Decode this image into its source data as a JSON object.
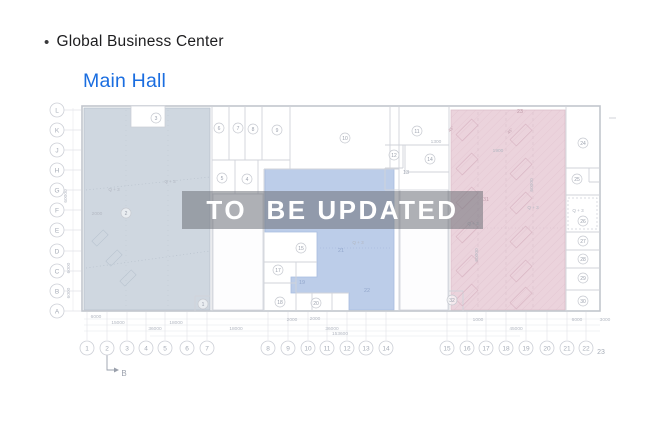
{
  "header": {
    "bullet": "•",
    "title": "Global Business Center",
    "subtitle": "Main Hall"
  },
  "watermark": {
    "text": "TO  BE UPDATED"
  },
  "plan": {
    "row_axis": [
      {
        "label": "L",
        "y": 110
      },
      {
        "label": "K",
        "y": 130
      },
      {
        "label": "J",
        "y": 150
      },
      {
        "label": "H",
        "y": 170
      },
      {
        "label": "G",
        "y": 190
      },
      {
        "label": "F",
        "y": 210
      },
      {
        "label": "E",
        "y": 230
      },
      {
        "label": "D",
        "y": 251
      },
      {
        "label": "C",
        "y": 271
      },
      {
        "label": "B",
        "y": 291
      },
      {
        "label": "A",
        "y": 311
      }
    ],
    "col_axis": [
      {
        "label": "1",
        "x": 87
      },
      {
        "label": "2",
        "x": 107
      },
      {
        "label": "3",
        "x": 127
      },
      {
        "label": "4",
        "x": 146
      },
      {
        "label": "5",
        "x": 165
      },
      {
        "label": "6",
        "x": 187
      },
      {
        "label": "7",
        "x": 207
      },
      {
        "label": "8",
        "x": 268
      },
      {
        "label": "9",
        "x": 288
      },
      {
        "label": "10",
        "x": 308
      },
      {
        "label": "11",
        "x": 327
      },
      {
        "label": "12",
        "x": 347
      },
      {
        "label": "13",
        "x": 366
      },
      {
        "label": "14",
        "x": 386
      },
      {
        "label": "15",
        "x": 447
      },
      {
        "label": "16",
        "x": 467
      },
      {
        "label": "17",
        "x": 486
      },
      {
        "label": "18",
        "x": 506
      },
      {
        "label": "19",
        "x": 526
      },
      {
        "label": "20",
        "x": 547
      },
      {
        "label": "21",
        "x": 567
      },
      {
        "label": "22",
        "x": 586
      }
    ],
    "col_axis_plain": {
      "label": "23",
      "x": 601,
      "y": 354
    },
    "section_marker": {
      "label": "B"
    },
    "rooms_circled": [
      {
        "n": "3",
        "x": 156,
        "y": 118
      },
      {
        "n": "6",
        "x": 219,
        "y": 128
      },
      {
        "n": "7",
        "x": 238,
        "y": 128
      },
      {
        "n": "8",
        "x": 253,
        "y": 129
      },
      {
        "n": "9",
        "x": 277,
        "y": 130
      },
      {
        "n": "10",
        "x": 345,
        "y": 138
      },
      {
        "n": "11",
        "x": 417,
        "y": 131
      },
      {
        "n": "12",
        "x": 394,
        "y": 155
      },
      {
        "n": "14",
        "x": 430,
        "y": 159
      },
      {
        "n": "5",
        "x": 222,
        "y": 178
      },
      {
        "n": "4",
        "x": 247,
        "y": 179
      },
      {
        "n": "2",
        "x": 126,
        "y": 213
      },
      {
        "n": "1",
        "x": 203,
        "y": 304
      },
      {
        "n": "15",
        "x": 301,
        "y": 248
      },
      {
        "n": "17",
        "x": 278,
        "y": 270
      },
      {
        "n": "18",
        "x": 280,
        "y": 302
      },
      {
        "n": "20",
        "x": 316,
        "y": 303
      },
      {
        "n": "24",
        "x": 583,
        "y": 143
      },
      {
        "n": "25",
        "x": 577,
        "y": 179
      },
      {
        "n": "26",
        "x": 583,
        "y": 221
      },
      {
        "n": "27",
        "x": 583,
        "y": 241
      },
      {
        "n": "28",
        "x": 583,
        "y": 259
      },
      {
        "n": "29",
        "x": 583,
        "y": 278
      },
      {
        "n": "30",
        "x": 583,
        "y": 301
      },
      {
        "n": "32",
        "x": 452,
        "y": 300
      }
    ],
    "rooms_plain": [
      {
        "n": "13",
        "x": 406,
        "y": 174,
        "c": "#a3a9b4"
      },
      {
        "n": "19",
        "x": 302,
        "y": 284,
        "c": "#93a7cc"
      },
      {
        "n": "21",
        "x": 341,
        "y": 252,
        "c": "#93a7cc"
      },
      {
        "n": "22",
        "x": 367,
        "y": 292,
        "c": "#93a7cc"
      },
      {
        "n": "31",
        "x": 486,
        "y": 201,
        "c": "#c3a0ae"
      },
      {
        "n": "23",
        "x": 520,
        "y": 113,
        "c": "#c09aa8"
      }
    ],
    "zone_labels": [
      {
        "t": "Q + 3",
        "x": 170,
        "y": 183
      },
      {
        "t": "Q + 3",
        "x": 114,
        "y": 191
      },
      {
        "t": "Q + 3",
        "x": 358,
        "y": 244
      },
      {
        "t": "Q + 3",
        "x": 473,
        "y": 225
      },
      {
        "t": "Q + 3",
        "x": 533,
        "y": 209
      },
      {
        "t": "Q + 3",
        "x": 578,
        "y": 212
      }
    ],
    "dims": [
      {
        "t": "6000",
        "x": 96,
        "y": 318
      },
      {
        "t": "15000",
        "x": 118,
        "y": 324
      },
      {
        "t": "18000",
        "x": 176,
        "y": 324
      },
      {
        "t": "36000",
        "x": 155,
        "y": 330
      },
      {
        "t": "18000",
        "x": 236,
        "y": 330
      },
      {
        "t": "2000",
        "x": 292,
        "y": 321
      },
      {
        "t": "36000",
        "x": 332,
        "y": 330
      },
      {
        "t": "153600",
        "x": 340,
        "y": 335
      },
      {
        "t": "2000",
        "x": 315,
        "y": 320
      },
      {
        "t": "1000",
        "x": 478,
        "y": 321
      },
      {
        "t": "45000",
        "x": 516,
        "y": 330
      },
      {
        "t": "6000",
        "x": 577,
        "y": 321
      },
      {
        "t": "3000",
        "x": 605,
        "y": 321
      },
      {
        "t": "1300",
        "x": 436,
        "y": 143
      },
      {
        "t": "1900",
        "x": 498,
        "y": 152
      },
      {
        "t": "2000",
        "x": 97,
        "y": 215
      },
      {
        "t": "60000",
        "x": 67,
        "y": 196,
        "rot": -90
      },
      {
        "t": "6000",
        "x": 70,
        "y": 268,
        "rot": -90
      },
      {
        "t": "6000",
        "x": 70,
        "y": 293,
        "rot": -90
      },
      {
        "t": "60000",
        "x": 478,
        "y": 255,
        "rot": -90
      },
      {
        "t": "60000",
        "x": 533,
        "y": 185,
        "rot": -90
      }
    ],
    "angle_labels": [
      {
        "t": "45°",
        "x": 452,
        "y": 130
      },
      {
        "t": "45°",
        "x": 511,
        "y": 132
      }
    ],
    "colors": {
      "left_zone": "#cfd7e0",
      "middle_zone": "#bccde9",
      "right_zone": "#ebd3dc",
      "wall": "#c2c6cd",
      "wall_light": "#d0d3da",
      "label": "#9ba1ad",
      "dim": "#b3b8c2",
      "axis": "#a6acb7",
      "accent_blue": "#1a6de0",
      "watermark_bg": "rgba(109,113,120,0.55)",
      "watermark_text": "#ffffff"
    }
  }
}
